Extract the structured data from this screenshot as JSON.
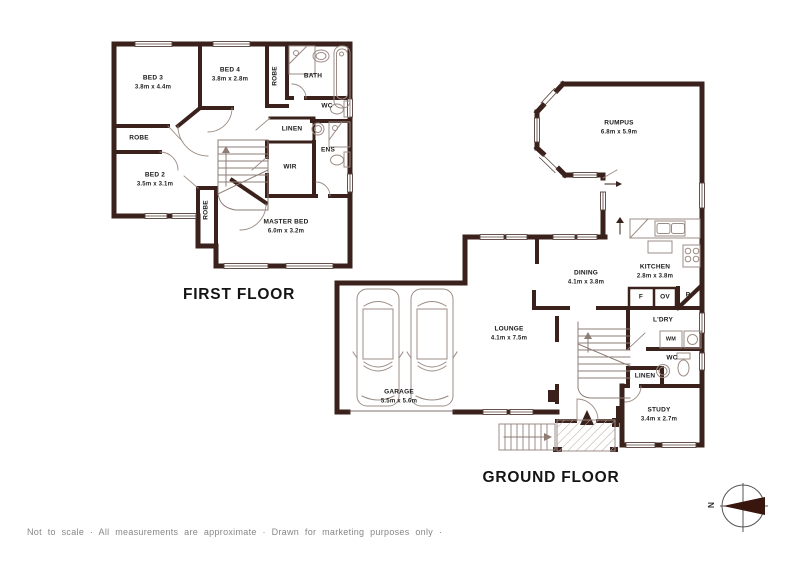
{
  "first_floor": {
    "title": "FIRST FLOOR",
    "rooms": {
      "bed3": {
        "name": "BED 3",
        "dims": "3.8m x 4.4m"
      },
      "bed4": {
        "name": "BED 4",
        "dims": "3.8m x 2.8m"
      },
      "bed2": {
        "name": "BED 2",
        "dims": "3.5m x 3.1m"
      },
      "master": {
        "name": "MASTER BED",
        "dims": "6.0m x 3.2m"
      },
      "bath": {
        "name": "BATH"
      },
      "wc": {
        "name": "WC"
      },
      "linen": {
        "name": "LINEN"
      },
      "ens": {
        "name": "ENS"
      },
      "wir": {
        "name": "WIR"
      },
      "robe_bed3": {
        "name": "ROBE"
      },
      "robe_bed4": {
        "name": "ROBE"
      },
      "robe_bed2": {
        "name": "ROBE"
      }
    }
  },
  "ground_floor": {
    "title": "GROUND FLOOR",
    "rooms": {
      "rumpus": {
        "name": "RUMPUS",
        "dims": "6.8m x 5.9m"
      },
      "kitchen": {
        "name": "KITCHEN",
        "dims": "2.8m x 3.8m"
      },
      "dining": {
        "name": "DINING",
        "dims": "4.1m x 3.8m"
      },
      "lounge": {
        "name": "LOUNGE",
        "dims": "4.1m x 7.5m"
      },
      "garage": {
        "name": "GARAGE",
        "dims": "5.5m x 5.6m"
      },
      "study": {
        "name": "STUDY",
        "dims": "3.4m x 2.7m"
      },
      "ldry": {
        "name": "L'DRY"
      },
      "wc": {
        "name": "WC"
      },
      "linen": {
        "name": "LINEN"
      },
      "wm": {
        "name": "WM"
      },
      "fridge": {
        "name": "F"
      },
      "oven": {
        "name": "OV"
      },
      "pantry": {
        "name": "P"
      }
    }
  },
  "footer": {
    "disclaimer": "Not to scale · All measurements are approximate · Drawn for marketing purposes only ·"
  },
  "compass": {
    "north_label": "N"
  },
  "colors": {
    "wall": "#3a211b",
    "fixture_line": "#9c8c84",
    "text": "#1a1a1a",
    "muted_text": "#878787"
  }
}
